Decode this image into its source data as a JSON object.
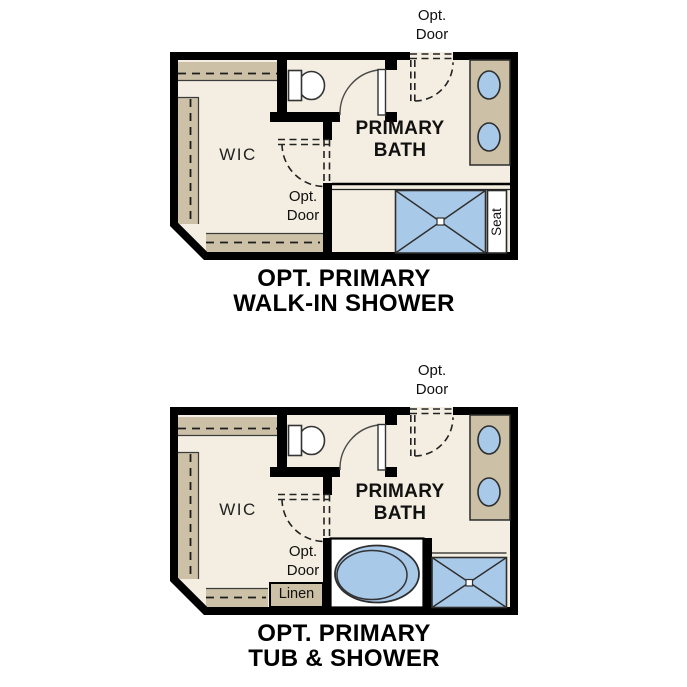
{
  "colors": {
    "wall": "#000000",
    "floor": "#f3eee1",
    "cabinet_tan": "#ccc0a7",
    "fixture_blue": "#a9c9e8",
    "text": "#111111",
    "background": "#ffffff"
  },
  "plans": [
    {
      "id": "walk-in-shower",
      "title_line1": "OPT. PRIMARY",
      "title_line2": "WALK-IN SHOWER",
      "labels": {
        "wic": "WIC",
        "bath_line1": "PRIMARY",
        "bath_line2": "BATH",
        "opt_door_top_line1": "Opt.",
        "opt_door_top_line2": "Door",
        "opt_door_mid_line1": "Opt.",
        "opt_door_mid_line2": "Door",
        "seat": "Seat"
      }
    },
    {
      "id": "tub-and-shower",
      "title_line1": "OPT. PRIMARY",
      "title_line2": "TUB & SHOWER",
      "labels": {
        "wic": "WIC",
        "bath_line1": "PRIMARY",
        "bath_line2": "BATH",
        "opt_door_top_line1": "Opt.",
        "opt_door_top_line2": "Door",
        "opt_door_mid_line1": "Opt.",
        "opt_door_mid_line2": "Door",
        "linen": "Linen"
      }
    }
  ]
}
